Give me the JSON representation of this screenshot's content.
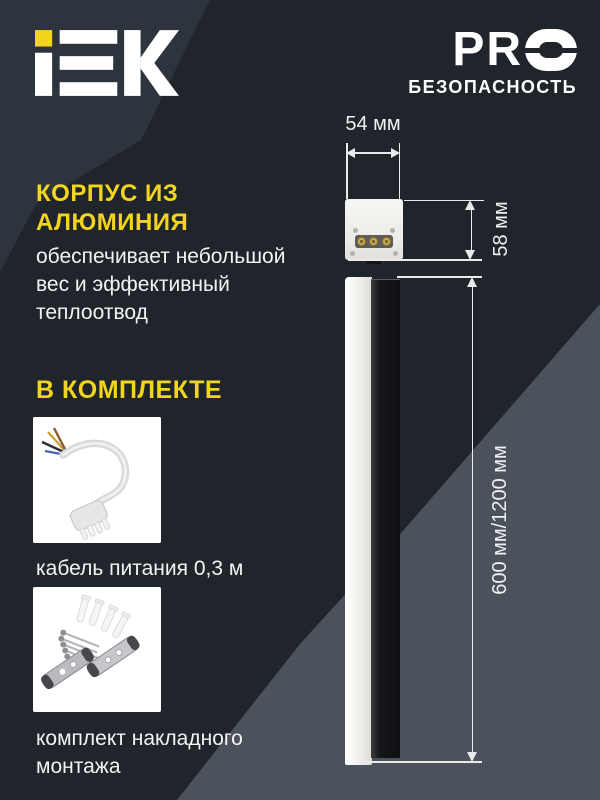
{
  "brand": {
    "name": "IEK",
    "pro_letters": "PR",
    "pro_title": "PRO",
    "pro_subtitle": "БЕЗОПАСНОСТЬ"
  },
  "feature": {
    "heading_lines": [
      "КОРПУС ИЗ",
      "АЛЮМИНИЯ"
    ],
    "body_lines": [
      "обеспечивает небольшой",
      "вес и эффективный",
      "теплоотвод"
    ]
  },
  "kit": {
    "heading": "В КОМПЛЕКТЕ",
    "items": [
      {
        "image": "power-cable",
        "caption_lines": [
          "кабель питания 0,3 м"
        ]
      },
      {
        "image": "mounting-kit",
        "caption_lines": [
          "комплект накладного",
          "монтажа"
        ]
      }
    ]
  },
  "dimensions": {
    "width": "54 мм",
    "height": "58 мм",
    "length": "600 мм/1200 мм"
  },
  "colors": {
    "accent_yellow": "#F3D41E",
    "background_dark": "#20252B",
    "background_slate_top_left": "#2E343D",
    "background_slate_bottom_right": "#4B525B",
    "text_white": "#F2F3F4",
    "dimension_line": "#E9EAEB",
    "housing_black": "#16171A",
    "diffuser_white": "#F2F0EC"
  }
}
